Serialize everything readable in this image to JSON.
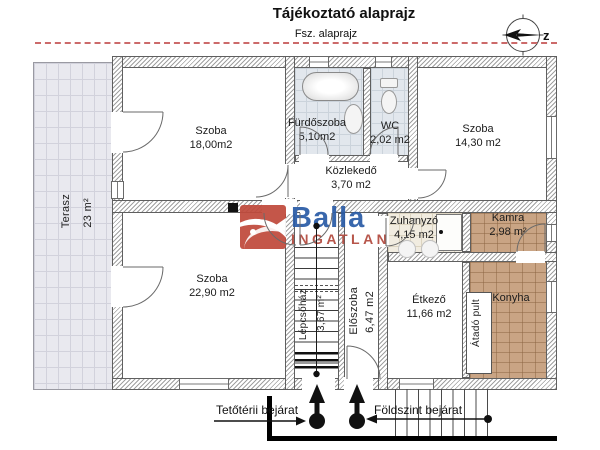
{
  "header": {
    "title": "Tájékoztató alaprajz",
    "subtitle": "Fsz. alaprajz"
  },
  "compass": {
    "label": "z"
  },
  "watermark": {
    "brand": "Balla",
    "subbrand": "INGATLAN"
  },
  "rooms": [
    {
      "name": "Szoba",
      "area": "18,00m2"
    },
    {
      "name": "Fürdőszoba",
      "area": "5,10m2"
    },
    {
      "name": "WC",
      "area": "2,02 m2"
    },
    {
      "name": "Szoba",
      "area": "14,30 m2"
    },
    {
      "name": "Közlekedő",
      "area": "3,70 m2"
    },
    {
      "name": "Terasz",
      "area": "23 m²"
    },
    {
      "name": "Szoba",
      "area": "22,90 m2"
    },
    {
      "name": "Lépcsőház",
      "area": "3,67 m²"
    },
    {
      "name": "Előszoba",
      "area": "6,47 m2"
    },
    {
      "name": "Zuhanyzó",
      "area": "4,15 m2"
    },
    {
      "name": "Kamra",
      "area": "2,98 m²"
    },
    {
      "name": "Konyha",
      "area": ""
    },
    {
      "name": "Étkező",
      "area": "11,66 m2"
    },
    {
      "name": "Átadó pult",
      "area": ""
    }
  ],
  "entrances": {
    "attic": "Tetőtérii bejárat",
    "ground": "Földszint bejárat"
  },
  "colors": {
    "wall_hatch": "#a0a0a0",
    "wall_edge": "#5f5f5f",
    "terrace_tile": "#e9e9ef",
    "bath_tile": "#e2e7ed",
    "pantry_tile": "#c9a484",
    "shower_tile": "#f1ece0",
    "logo_blue": "#2b5ca6",
    "logo_red": "#b24a3e",
    "boundary_red": "#cc6a6a"
  }
}
